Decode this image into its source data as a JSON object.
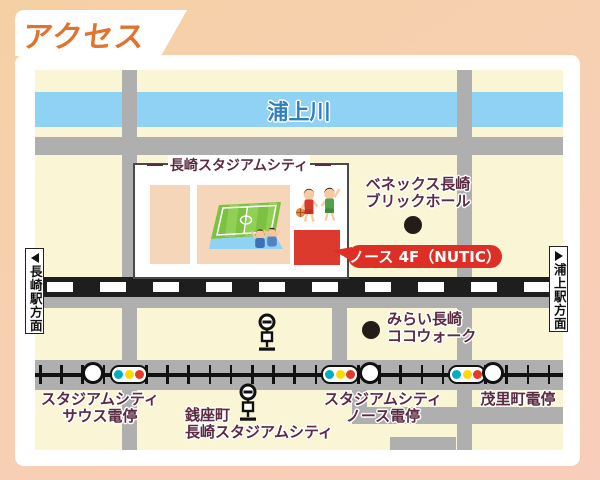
{
  "title": "アクセス",
  "map": {
    "river_label": "浦上川",
    "stadium_box_label": "長崎スタジアムシティ",
    "brick_hall": {
      "line1": "ベネックス長崎",
      "line2": "ブリックホール"
    },
    "nutic_callout": "ノース 4F（NUTIC）",
    "cocowalk": {
      "line1": "みらい長崎",
      "line2": "ココウォーク"
    },
    "direction_left": "長崎駅方面",
    "direction_right": "浦上駅方面",
    "tram_stops": [
      {
        "line1": "スタジアムシティ",
        "line2": "サウス電停"
      },
      {
        "line1": "銭座町",
        "line2": "長崎スタジアムシティ"
      },
      {
        "line1": "スタジアムシティ",
        "line2": "ノース電停"
      },
      {
        "line1": "茂里町電停",
        "line2": ""
      }
    ]
  },
  "colors": {
    "accent_orange": "#E0742E",
    "background_peach": "#F6D1A8",
    "map_cream": "#FAF6D5",
    "river_blue": "#8FD2F3",
    "road_gray": "#AFAFAF",
    "rail_black": "#1E1E1E",
    "label_maroon": "#5B2B42",
    "highlight_red": "#DD2F26",
    "signal_teal": "#00AEC3",
    "signal_yellow": "#FFD900",
    "signal_red": "#E73828"
  }
}
